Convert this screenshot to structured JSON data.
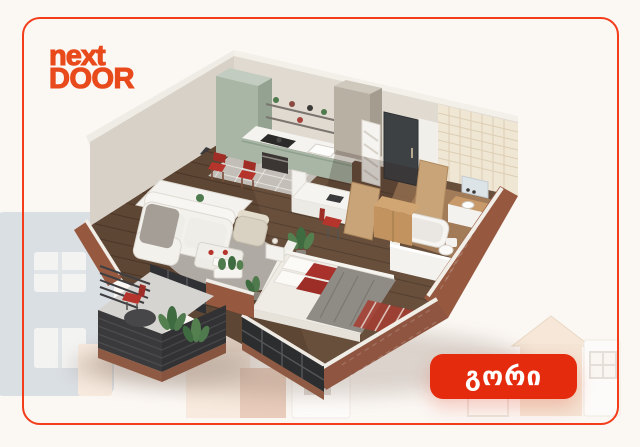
{
  "logo": {
    "line1": "next",
    "line2": "DOOR"
  },
  "location_button": {
    "label": "გორი"
  },
  "colors": {
    "frame-red": "#f23c1a",
    "logo-red": "#e84a1c",
    "button-red": "#e52b0e",
    "button-text": "#ffffff"
  },
  "illustration": {
    "type": "3d-isometric-apartment-floorplan",
    "rooms_depicted": [
      "kitchen",
      "dining-area",
      "living-room",
      "bedroom",
      "bathroom",
      "hallway",
      "balcony"
    ],
    "palette": {
      "brick": "#96583f",
      "sage-cabinets": "#a9b6a6",
      "wood-floor": "#5e4634",
      "walls": "#dcd6cd",
      "charcoal": "#3a3a3c",
      "furniture-accent-red": "#b5342c"
    }
  }
}
